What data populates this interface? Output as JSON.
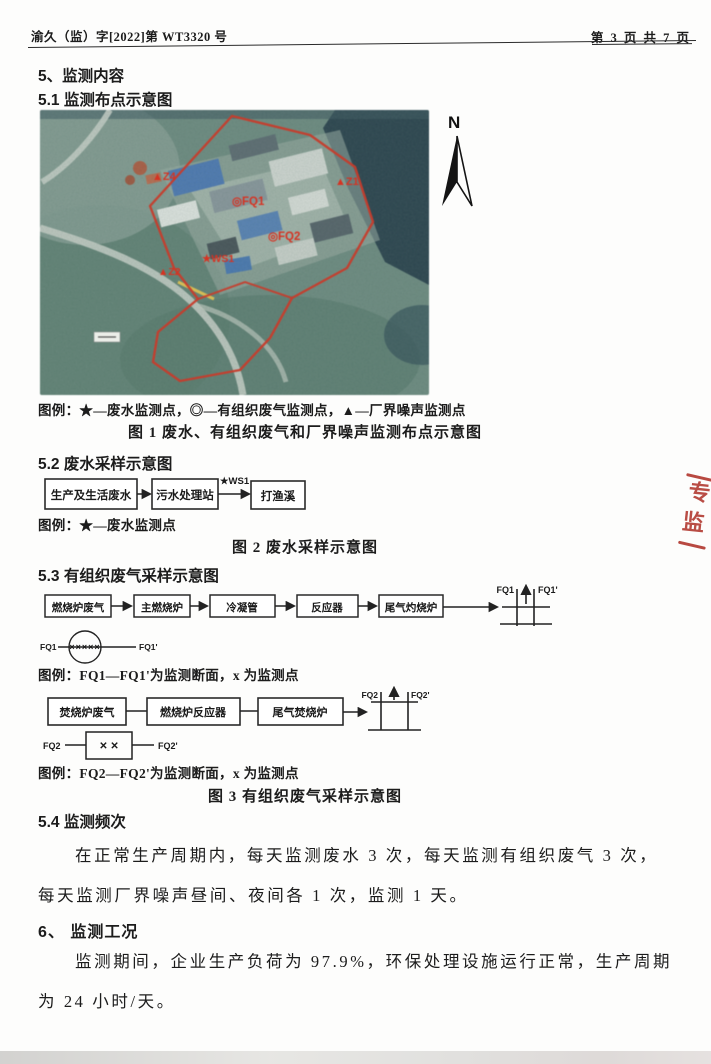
{
  "header": {
    "doc_no": "渝久（监）字[2022]第 WT3320 号",
    "page_info": "第 3 页 共 7 页"
  },
  "s5": {
    "title": "5、监测内容"
  },
  "s5_1": {
    "title": "5.1 监测布点示意图",
    "map": {
      "compass": "N",
      "labels": {
        "z4": "▲Z4",
        "fq1": "◎FQ1",
        "z1": "▲Z1",
        "fq2": "◎FQ2",
        "ws1": "★WS1",
        "z2": "▲Z2"
      }
    },
    "legend": "图例：★—废水监测点，◎—有组织废气监测点，▲—厂界噪声监测点",
    "caption": "图 1 废水、有组织废气和厂界噪声监测布点示意图"
  },
  "s5_2": {
    "title": "5.2 废水采样示意图",
    "flow": {
      "nodes": [
        "生产及生活废水",
        "污水处理站",
        "打渔溪"
      ],
      "arrow_label": "★WS1"
    },
    "legend": "图例：★—废水监测点",
    "caption": "图 2 废水采样示意图"
  },
  "s5_3": {
    "title": "5.3 有组织废气采样示意图",
    "flow1": {
      "nodes": [
        "燃烧炉废气",
        "主燃烧炉",
        "冷凝管",
        "反应器",
        "尾气灼烧炉"
      ],
      "stack": {
        "left": "FQ1",
        "right": "FQ1'"
      }
    },
    "section1": {
      "left": "FQ1",
      "marks": "×××××",
      "right": "FQ1'"
    },
    "legend1": "图例：FQ1—FQ1'为监测断面，x 为监测点",
    "flow2": {
      "nodes": [
        "焚烧炉废气",
        "燃烧炉反应器",
        "尾气焚烧炉"
      ],
      "stack": {
        "left": "FQ2",
        "right": "FQ2'"
      }
    },
    "section2": {
      "left": "FQ2",
      "marks": "✕ ✕",
      "right": "FQ2'"
    },
    "legend2": "图例：FQ2—FQ2'为监测断面，x 为监测点",
    "caption": "图 3 有组织废气采样示意图"
  },
  "s5_4": {
    "title": "5.4 监测频次",
    "line1": "在正常生产周期内，每天监测废水 3 次，每天监测有组织废气 3 次，",
    "line2": "每天监测厂界噪声昼间、夜间各 1 次，监测 1 天。"
  },
  "s6": {
    "title": "6、 监测工况",
    "line1": "监测期间，企业生产负荷为 97.9%，环保处理设施运行正常，生产周期",
    "line2": "为 24 小时/天。"
  },
  "stamp": {
    "char1": "专",
    "char2": "监"
  },
  "colors": {
    "boundary_red": "#d03a28",
    "label_red": "#e0301e",
    "stamp_red": "#b0352c"
  }
}
